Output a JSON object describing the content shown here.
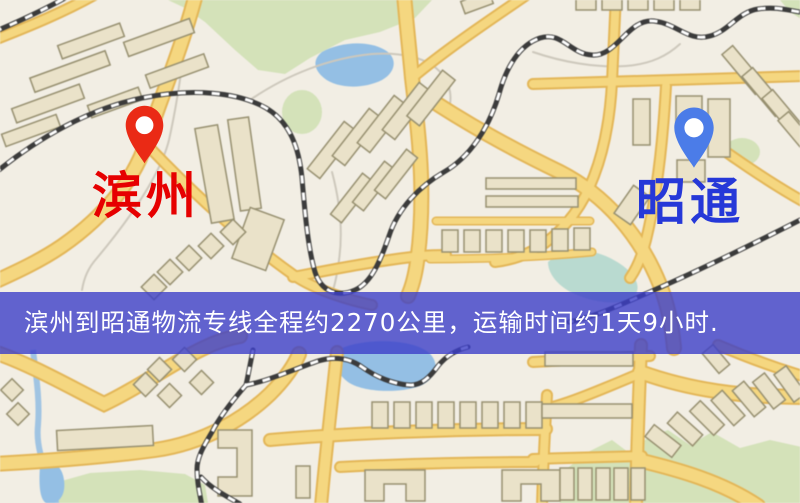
{
  "map": {
    "origin": {
      "label": "滨州",
      "pin_icon": "red-map-pin"
    },
    "destination": {
      "label": "昭通",
      "pin_icon": "blue-map-pin"
    }
  },
  "banner": {
    "text": "滨州到昭通物流专线全程约2270公里，运输时间约1天9小时.",
    "distance": "约2270公里",
    "duration": "约1天9小时"
  },
  "colors": {
    "map_bg": "#f2eee4",
    "road": "#f6d77c",
    "road_casing": "#e5b653",
    "rail": "#3b3b3b",
    "water": "#92bfe6",
    "park": "#d4e2b8",
    "building_fill": "#eae2c8",
    "building_stroke": "#97906f",
    "origin_pin": "#ea2a15",
    "destination_pin": "#4b7ce8",
    "origin_label": "#e60000",
    "destination_label": "#2638d8",
    "banner_bg": "rgba(60,62,200,0.8)",
    "banner_text": "#ffffff"
  }
}
